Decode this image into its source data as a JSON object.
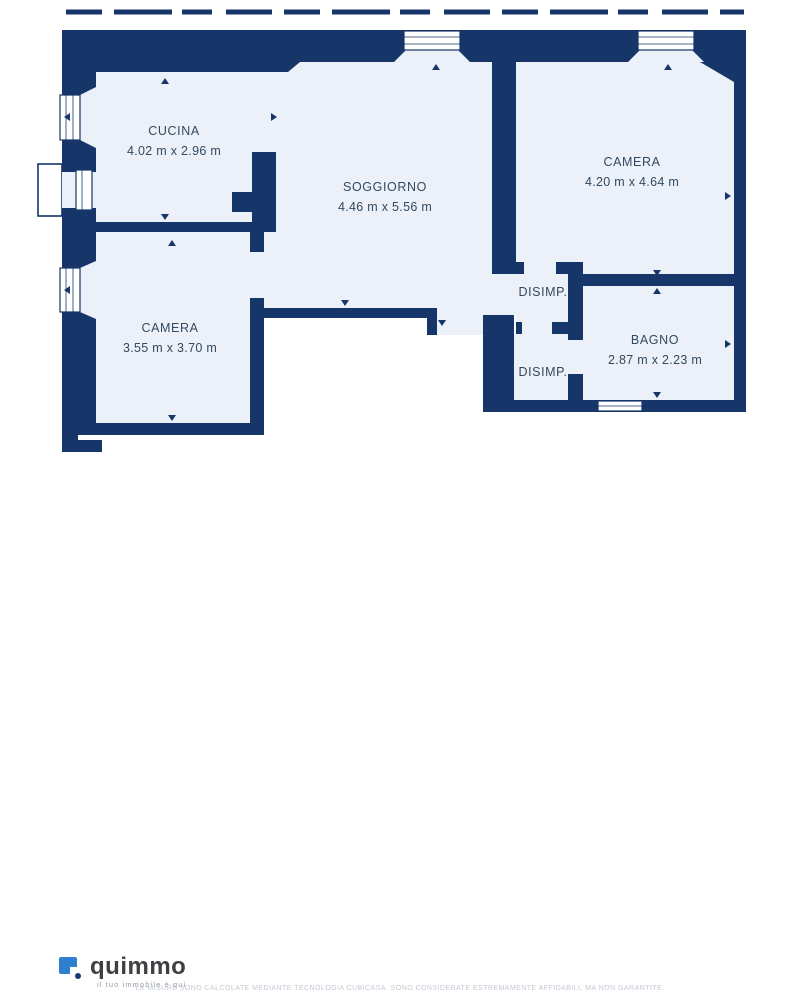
{
  "plan": {
    "rooms": {
      "cucina": {
        "label": "CUCINA",
        "dims": "4.02 m x 2.96 m"
      },
      "soggiorno": {
        "label": "SOGGIORNO",
        "dims": "4.46 m x 5.56 m"
      },
      "camera1": {
        "label": "CAMERA",
        "dims": "4.20 m x 4.64 m"
      },
      "camera2": {
        "label": "CAMERA",
        "dims": "3.55 m x 3.70 m"
      },
      "disimp1": {
        "label": "DISIMP."
      },
      "disimp2": {
        "label": "DISIMP."
      },
      "bagno": {
        "label": "BAGNO",
        "dims": "2.87 m x 2.23 m"
      }
    },
    "colors": {
      "wall": "#163569",
      "room_fill": "#ecf1f9",
      "outside": "#ffffff",
      "label_text": "#33495f"
    }
  },
  "footer": {
    "brand": "quimmo",
    "tagline": "il tuo immobile è qui",
    "logo_blue": "#2e7fd0",
    "disclaimer": "LE MISURE SONO CALCOLATE MEDIANTE TECNOLOGIA CUBICASA. SONO CONSIDERATE ESTREMAMENTE AFFIDABILI, MA NON GARANTITE."
  }
}
